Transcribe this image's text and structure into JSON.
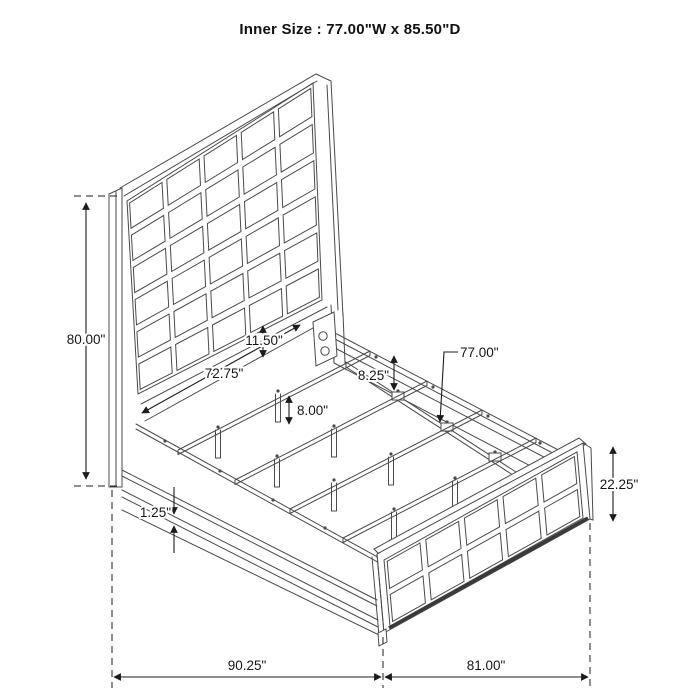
{
  "title": "Inner Size : 77.00\"W x 85.50\"D",
  "dimensions": {
    "headboard_height": "80.00\"",
    "headboard_width": "72.75\"",
    "panel_to_rail_gap": "11.50\"",
    "rail_height": "8.25\"",
    "slat_leg_height": "8.00\"",
    "slat_length": "77.00\"",
    "footboard_height": "22.25\"",
    "rail_trim": "1.25\"",
    "overall_depth": "90.25\"",
    "overall_width": "81.00\""
  },
  "colors": {
    "background": "#ffffff",
    "art_line": "#4a4a4a",
    "dimension_line": "#1c1c1c",
    "text": "#161616",
    "title_text": "#111111"
  }
}
